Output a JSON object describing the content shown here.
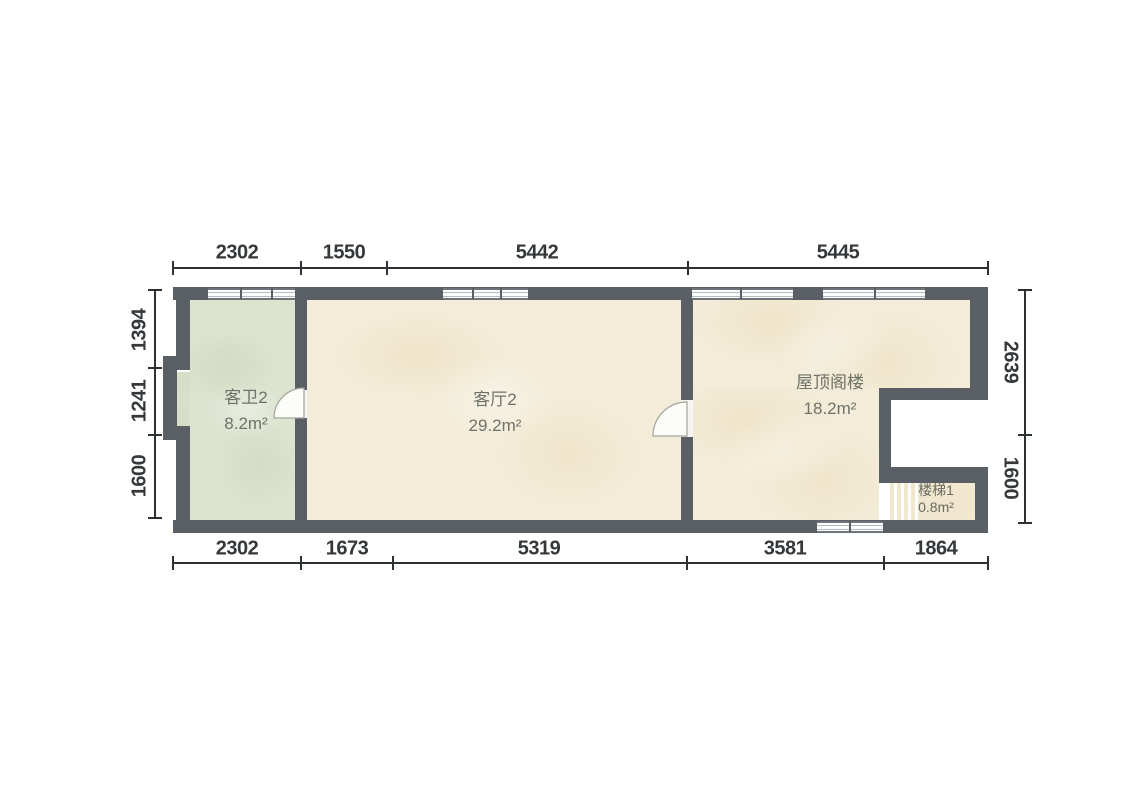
{
  "floor_plan": {
    "rooms": [
      {
        "name": "客卫2",
        "area": "8.2m²"
      },
      {
        "name": "客厅2",
        "area": "29.2m²"
      },
      {
        "name": "屋顶阁楼",
        "area": "18.2m²"
      },
      {
        "name": "楼梯1",
        "area": "0.8m²"
      }
    ],
    "dimensions": {
      "top": [
        "2302",
        "1550",
        "5442",
        "5445"
      ],
      "bottom": [
        "2302",
        "1673",
        "5319",
        "3581",
        "1864"
      ],
      "left": [
        "1394",
        "1241",
        "1600"
      ],
      "right": [
        "2639",
        "1600"
      ]
    },
    "colors": {
      "wall": "#5a5f66",
      "floor_main": "#f3ecd8",
      "floor_bath": "#dce3cf",
      "dim_text": "#34383b",
      "room_text": "#6f7268",
      "background": "#ffffff"
    }
  }
}
